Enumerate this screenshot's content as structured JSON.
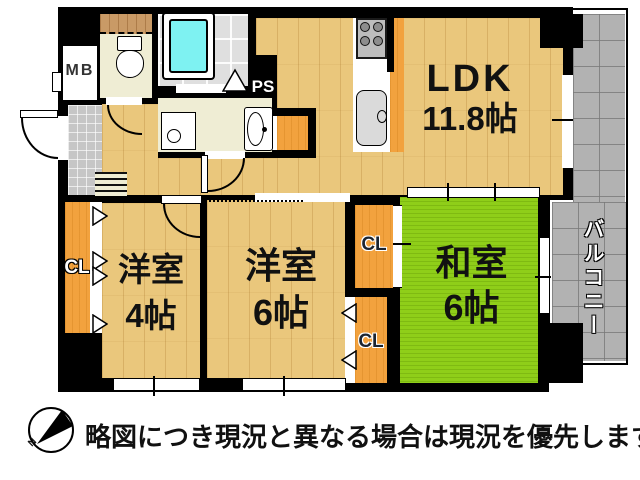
{
  "rooms": {
    "ldk": {
      "name": "LDK",
      "size": "11.8帖"
    },
    "washitsu": {
      "name": "和室",
      "size": "6帖"
    },
    "yoshitsu6": {
      "name": "洋室",
      "size": "6帖"
    },
    "yoshitsu4": {
      "name": "洋室",
      "size": "4帖"
    },
    "balcony": "バルコニー"
  },
  "closets": {
    "west": "CL",
    "north": "CL",
    "south": "CL"
  },
  "utilities": {
    "meter_box": "MB",
    "pipe_space": "PS"
  },
  "compass": {
    "north_label": "N"
  },
  "footer": {
    "disclaimer": "略図につき現況と異なる場合は現況を優先します"
  },
  "colors": {
    "wall": "#000000",
    "wood": "#EAC77C",
    "tatami": "#8FCE19",
    "closet": "#F2A23E",
    "balcony": "#B2B2B2",
    "cream": "#EFEDD4",
    "bathtile": "#DFDFDF",
    "bathtub": "#7EF2F2",
    "kitchen_edge": "#F2A23E"
  }
}
